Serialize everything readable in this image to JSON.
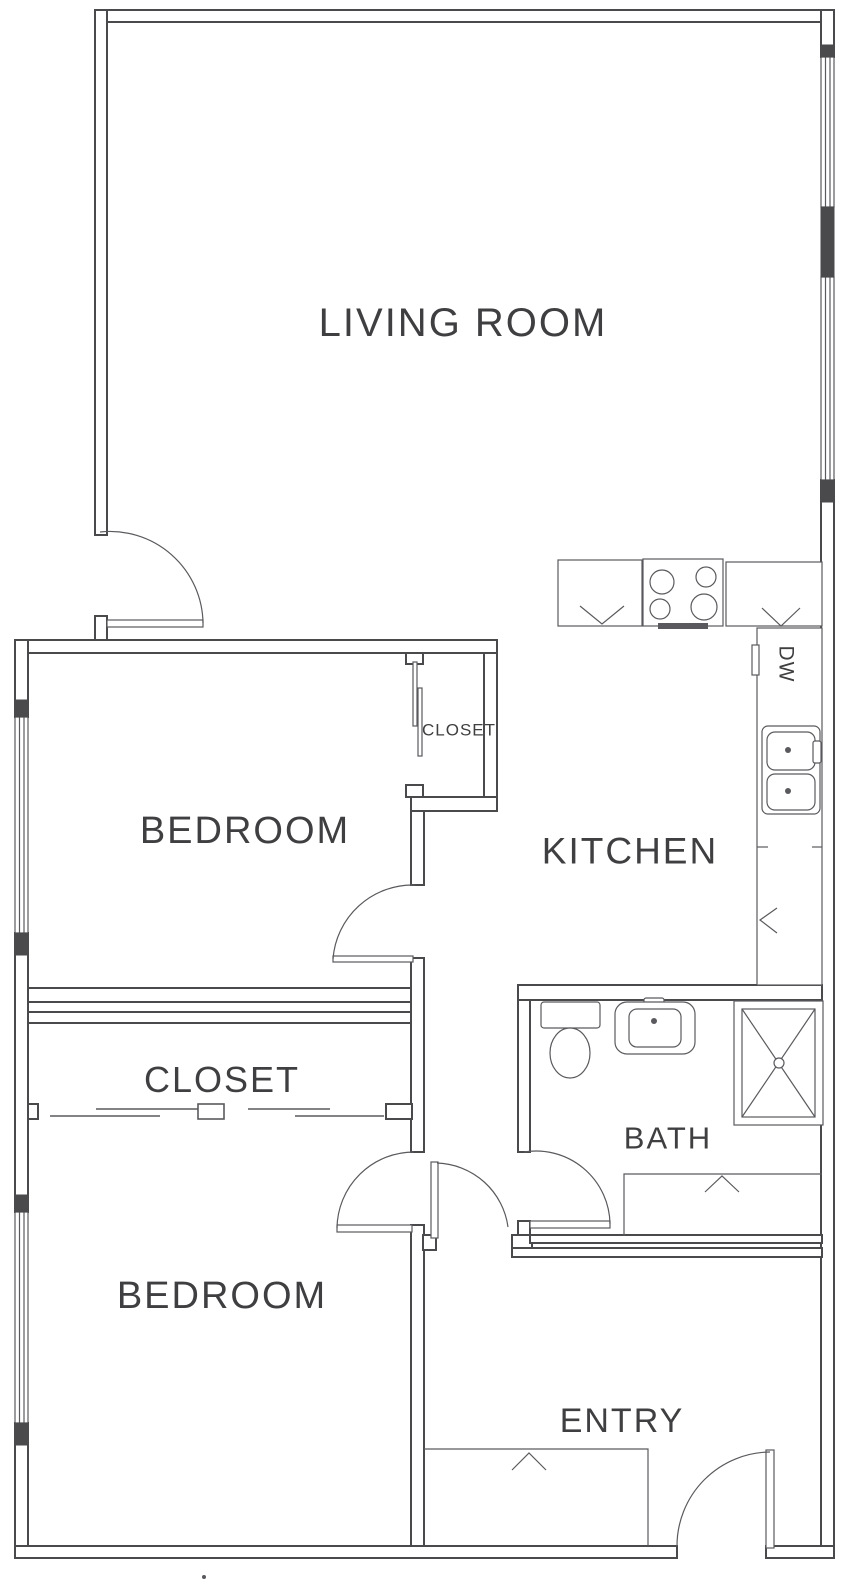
{
  "plan": {
    "title": "Apartment floor plan (scanned architectural drawing)",
    "labels": {
      "living_room": "LIVING ROOM",
      "bedroom_top": "BEDROOM",
      "bedroom_closet": "CLOSET",
      "kitchen": "KITCHEN",
      "closet_room": "CLOSET",
      "bath": "BATH",
      "bedroom_bottom": "BEDROOM",
      "entry": "ENTRY",
      "dishwasher": "DW"
    },
    "fixtures": [
      "stove-4-burner",
      "kitchen-double-sink",
      "dishwasher",
      "cabinet-chevron-marks",
      "toilet",
      "vanity-sink",
      "shower-stall",
      "bath-cabinet",
      "entry-closet",
      "sliding-closet-doors",
      "swing-doors-with-arcs",
      "windows-in-walls"
    ],
    "colors": {
      "wall_line": "#4a4a4d",
      "fixture_line": "#5a5a5e",
      "label_text": "#3f3f41",
      "background": "#ffffff"
    }
  }
}
